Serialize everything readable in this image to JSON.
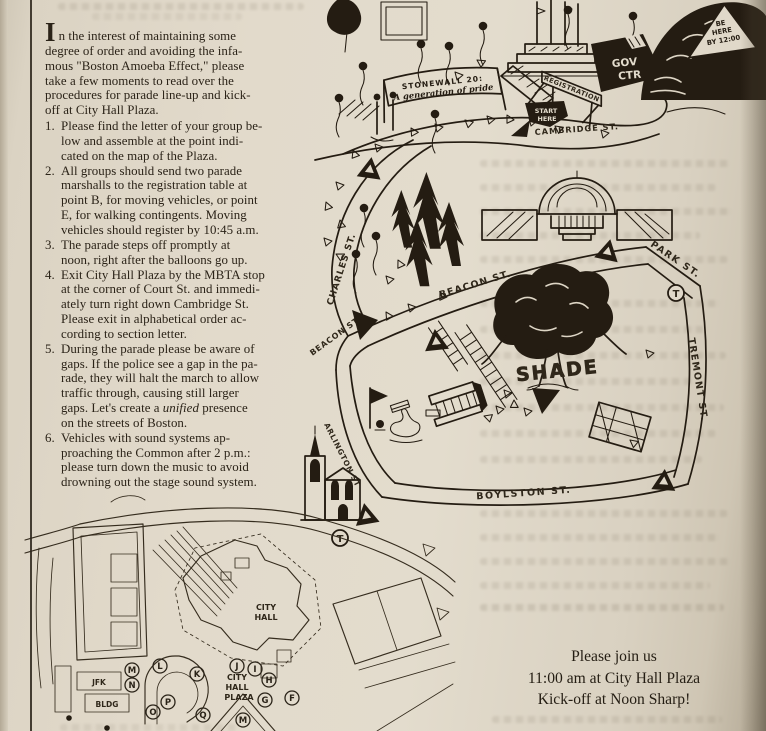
{
  "colors": {
    "paper": "#e0d8c9",
    "ink": "#241c12"
  },
  "intro": {
    "dropcap": "I",
    "text": "n the interest of maintaining some\ndegree of order and avoiding the infa-\nmous \"Boston Amoeba Effect,\" please\ntake a few moments to read over the\nprocedures for parade line-up and kick-\noff at City Hall Plaza."
  },
  "instructions": [
    {
      "num": "1.",
      "text": "Please find the letter of your group be-\nlow and assemble at the point indi-\ncated on the map of the Plaza."
    },
    {
      "num": "2.",
      "text": "All groups should send two parade\nmarshalls to the registration table at\npoint B, for moving vehicles, or point\nE, for walking contingents. Moving\nvehicles should register by 10:45 a.m."
    },
    {
      "num": "3.",
      "text": "The parade steps off promptly at\nnoon, right after the balloons go up."
    },
    {
      "num": "4.",
      "text": "Exit City Hall Plaza by the MBTA stop\nat the corner of Court St. and immedi-\nately turn right down Cambridge St.\nPlease exit in alphabetical order ac-\ncording to section letter."
    },
    {
      "num": "5.",
      "pre": "During the parade please be aware of\ngaps. If the police see a gap in the pa-\nrade, they will halt the march to allow\ntraffic through, causing still larger\ngaps. Let's create a ",
      "italic": "unified",
      "post": " presence\non the streets of Boston."
    },
    {
      "num": "6.",
      "text": "Vehicles with sound systems ap-\nproaching the Common after 2 p.m.:\nplease turn down the music to avoid\ndrowning out the stage sound system."
    }
  ],
  "staging_map": {
    "banner_line1": "STONEWALL 20:",
    "banner_line2": "A generation of pride",
    "registration_label": "REGISTRATION",
    "start_line1": "START",
    "start_line2": "HERE",
    "gov_line1": "GOV",
    "gov_line2": "CTR",
    "behere_line1": "BE",
    "behere_line2": "HERE",
    "behere_line3": "BY 12:00",
    "cambridge_st": "CAMBRIDGE ST."
  },
  "common_map": {
    "charles_st": "CHARLES ST.",
    "beacon_st": "BEACON ST.",
    "beacon_st_2": "BEACON ST.",
    "park_st": "PARK ST.",
    "tremont_st": "TREMONT ST.",
    "boylston_st": "BOYLSTON ST.",
    "arlington_st": "ARLINGTON ST",
    "shade_label": "SHADE",
    "t_label": "T"
  },
  "plaza_map": {
    "jfk": "JFK",
    "bldg": "BLDG",
    "city_hall_line1": "CITY",
    "city_hall_line2": "HALL",
    "plaza_line1": "CITY",
    "plaza_line2": "HALL",
    "plaza_line3": "PLAZA",
    "letters": [
      "M",
      "N",
      "L",
      "K",
      "J",
      "I",
      "H",
      "G",
      "F",
      "P",
      "O",
      "Q",
      "M"
    ]
  },
  "invitation": {
    "line1": "Please join us",
    "line2": "11:00 am at City Hall Plaza",
    "line3": "Kick-off at Noon Sharp!"
  }
}
